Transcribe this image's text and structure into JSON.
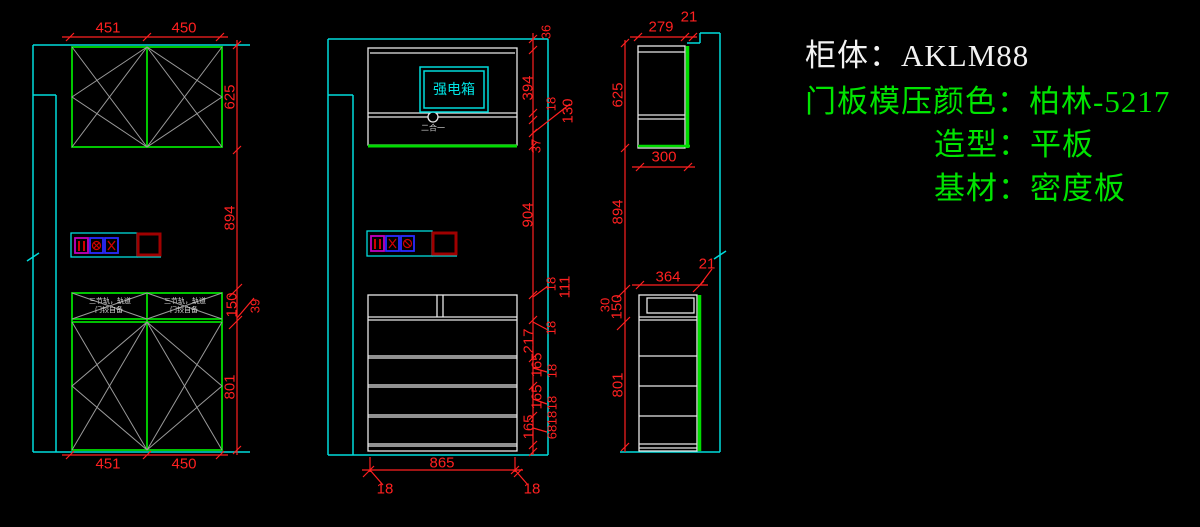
{
  "title_block": {
    "cabinet": "柜体：AKLM88",
    "door_color": "门板模压颜色：柏林-5217",
    "shape": "造型：平板",
    "base_material": "基材：密度板"
  },
  "annotations": {
    "electric_box": "强电箱",
    "two_in_one": "二合一",
    "drawer_note_line1": "三节轨，轨道",
    "drawer_note_line2": "门铰自备"
  },
  "dims": {
    "left_top": [
      "451",
      "450"
    ],
    "left_right_chain": [
      "625",
      "894",
      "150",
      "39",
      "801"
    ],
    "left_bottom": [
      "451",
      "450"
    ],
    "middle_chain": [
      "36",
      "394",
      "18",
      "130",
      "37",
      "904",
      "18",
      "111",
      "18",
      "217",
      "165",
      "18",
      "165",
      "18",
      "165",
      "18",
      "68"
    ],
    "middle_bottom": [
      "865",
      "18",
      "18"
    ],
    "right_upper_top": [
      "279",
      "21"
    ],
    "right_upper_left": [
      "625"
    ],
    "right_upper_bottom": [
      "300"
    ],
    "right_left_chain": [
      "894",
      "30",
      "150",
      "801"
    ],
    "right_lower_top": [
      "364",
      "21"
    ]
  },
  "colors": {
    "background": "#000000",
    "wall": "#00dcdc",
    "panel": "#00dc00",
    "outline": "#e8e8e8",
    "dimension": "#ff2020",
    "hatch": "#9a9a9a",
    "socket_box_dark_red": "#a00000",
    "socket_border_blue": "#2a2aff",
    "socket_border_magenta": "#c000c0"
  },
  "icons": {
    "socket_bars": "double-bar-socket",
    "socket_circle_x": "circle-x-socket",
    "socket_x": "x-socket",
    "junction_square": "junction-box-square"
  }
}
